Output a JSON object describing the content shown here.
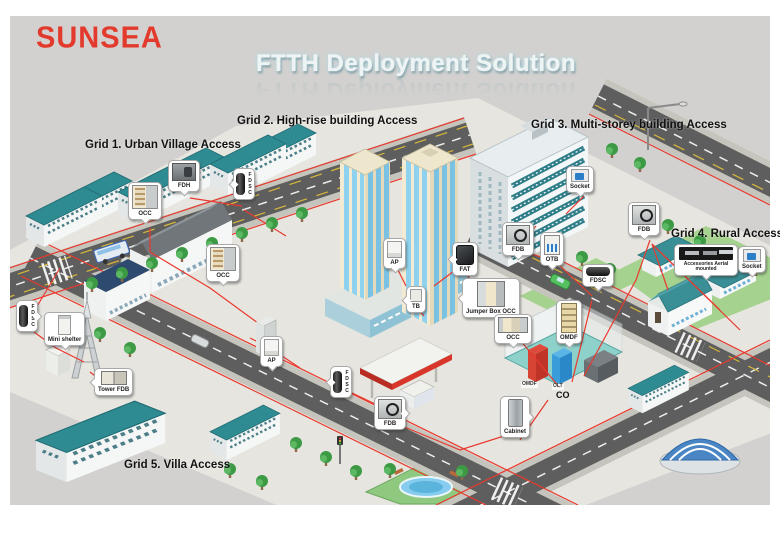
{
  "brand": {
    "logo_text": "SUNSEA"
  },
  "title": "FTTH Deployment Solution",
  "grid_labels": {
    "grid1": "Grid 1. Urban Village Access",
    "grid2": "Grid 2. High-rise building Access",
    "grid3": "Grid 3. Multi-storey building Access",
    "grid4": "Grid 4. Rural Access",
    "grid5": "Grid 5. Villa Access"
  },
  "callouts": {
    "occ1": "OCC",
    "fdh1": "FDH",
    "fdsc1": "FDSC",
    "occ2": "OCC",
    "ap1": "AP",
    "tb1": "TB",
    "fat1": "FAT",
    "jumper_occ": "Jumper Box OCC",
    "fdb1": "FDB",
    "otb1": "OTB",
    "socket1": "Socket",
    "fdsc2": "FDSC",
    "occ3": "OCC",
    "omdf1": "OMDF",
    "cabinet1": "Cabinet",
    "fdb2": "FDB",
    "fdsc3": "FDSC",
    "ap2": "AP",
    "fdsc4": "FDSC",
    "mini_shelter": "Mini shelter",
    "tower_fdb": "Tower FDB",
    "fdb3": "FDB",
    "accessories": "Accessories Aerial mounted",
    "socket2": "Socket"
  },
  "co_site": {
    "building_label": "CO",
    "omdf_cabinet": "OMDF",
    "olt_cabinet": "OLT"
  },
  "colors": {
    "logo_red": "#e23b2e",
    "fiber_red": "#e8392e",
    "title_glow": "#a9dbe6",
    "roof_teal": "#2f8b92",
    "road_gray": "#5e5e5e",
    "background_gray": "#d2d1cf",
    "highrise_wall": "#f2ead2",
    "window_blue": "#8fd2ef"
  }
}
